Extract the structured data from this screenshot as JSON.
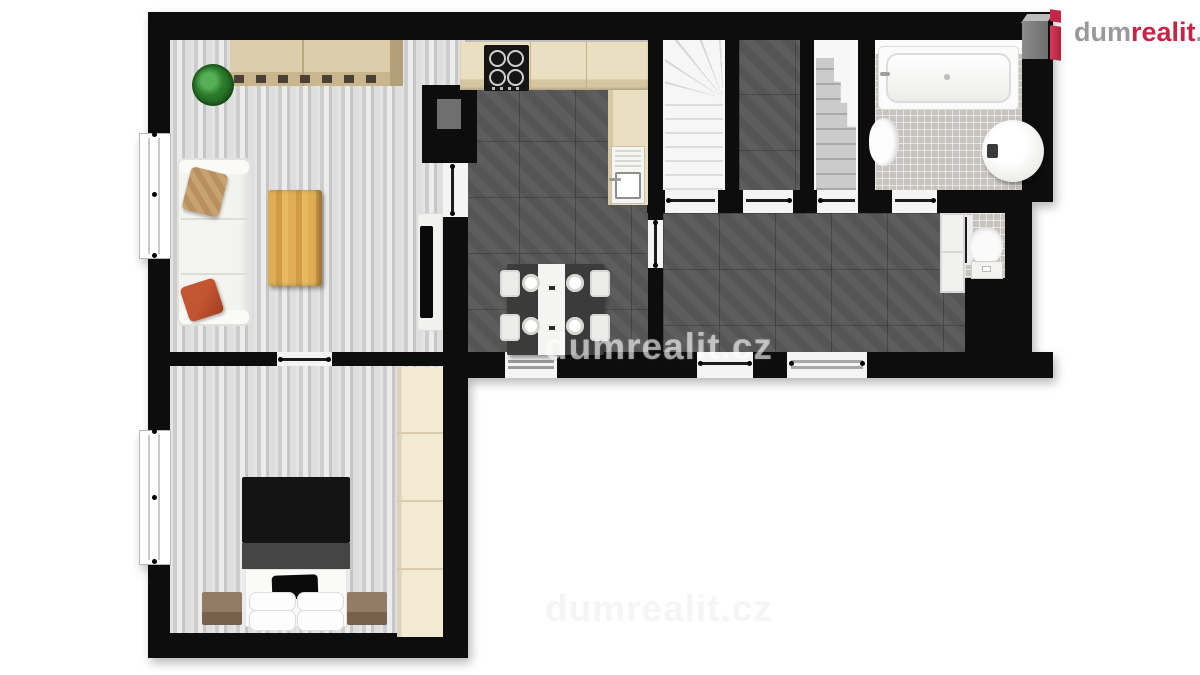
{
  "logo": {
    "brand_prefix": "dum",
    "brand_mid": "realit",
    "brand_suffix": ".cz",
    "red": "#c32646",
    "gray": "#999999",
    "icon": "dumrealit-house-icon"
  },
  "watermark": {
    "center": "dumrealit.cz",
    "bottom": "dumrealit.cz"
  },
  "floorplan": {
    "style": "3d-top-down-render",
    "wall_color": "#0d0d0d",
    "rooms": [
      {
        "name": "living-room",
        "floor": "light-wood-plank",
        "furniture": [
          "sideboard",
          "potted-plant",
          "sofa-with-pillows",
          "coffee-table",
          "tv-on-board"
        ]
      },
      {
        "name": "kitchen-dining",
        "floor": "dark-gray-tile",
        "furniture": [
          "l-shaped-counter",
          "cooktop",
          "sink",
          "dining-table",
          "four-chairs",
          "four-plates"
        ]
      },
      {
        "name": "staircase-up",
        "floor": "white-stairs",
        "furniture": [
          "winder-staircase"
        ]
      },
      {
        "name": "storage-closet",
        "floor": "dark-gray-tile",
        "furniture": []
      },
      {
        "name": "staircase-down",
        "floor": "concrete-stairs",
        "furniture": [
          "stepped-staircase"
        ]
      },
      {
        "name": "bathroom",
        "floor": "light-mosaic-tile",
        "furniture": [
          "bathtub",
          "bidet-toilet",
          "water-heater-cylinder"
        ]
      },
      {
        "name": "hallway",
        "floor": "dark-gray-tile",
        "furniture": [
          "tall-cabinet"
        ]
      },
      {
        "name": "wc",
        "floor": "light-mosaic-tile",
        "furniture": [
          "toilet"
        ]
      },
      {
        "name": "bedroom",
        "floor": "light-wood-plank",
        "furniture": [
          "double-bed",
          "black-pillow",
          "white-pillows",
          "nightstand-left",
          "nightstand-right",
          "wardrobe"
        ]
      }
    ],
    "openings": [
      "living-bedroom-door",
      "living-kitchen-door",
      "kitchen-hall-door",
      "kitchen-south-door",
      "hall-entrance-door",
      "hall-glass-door",
      "stair1-door",
      "closet-door",
      "stair2-door",
      "bathroom-door",
      "wc-door",
      "living-window",
      "bedroom-window"
    ]
  }
}
